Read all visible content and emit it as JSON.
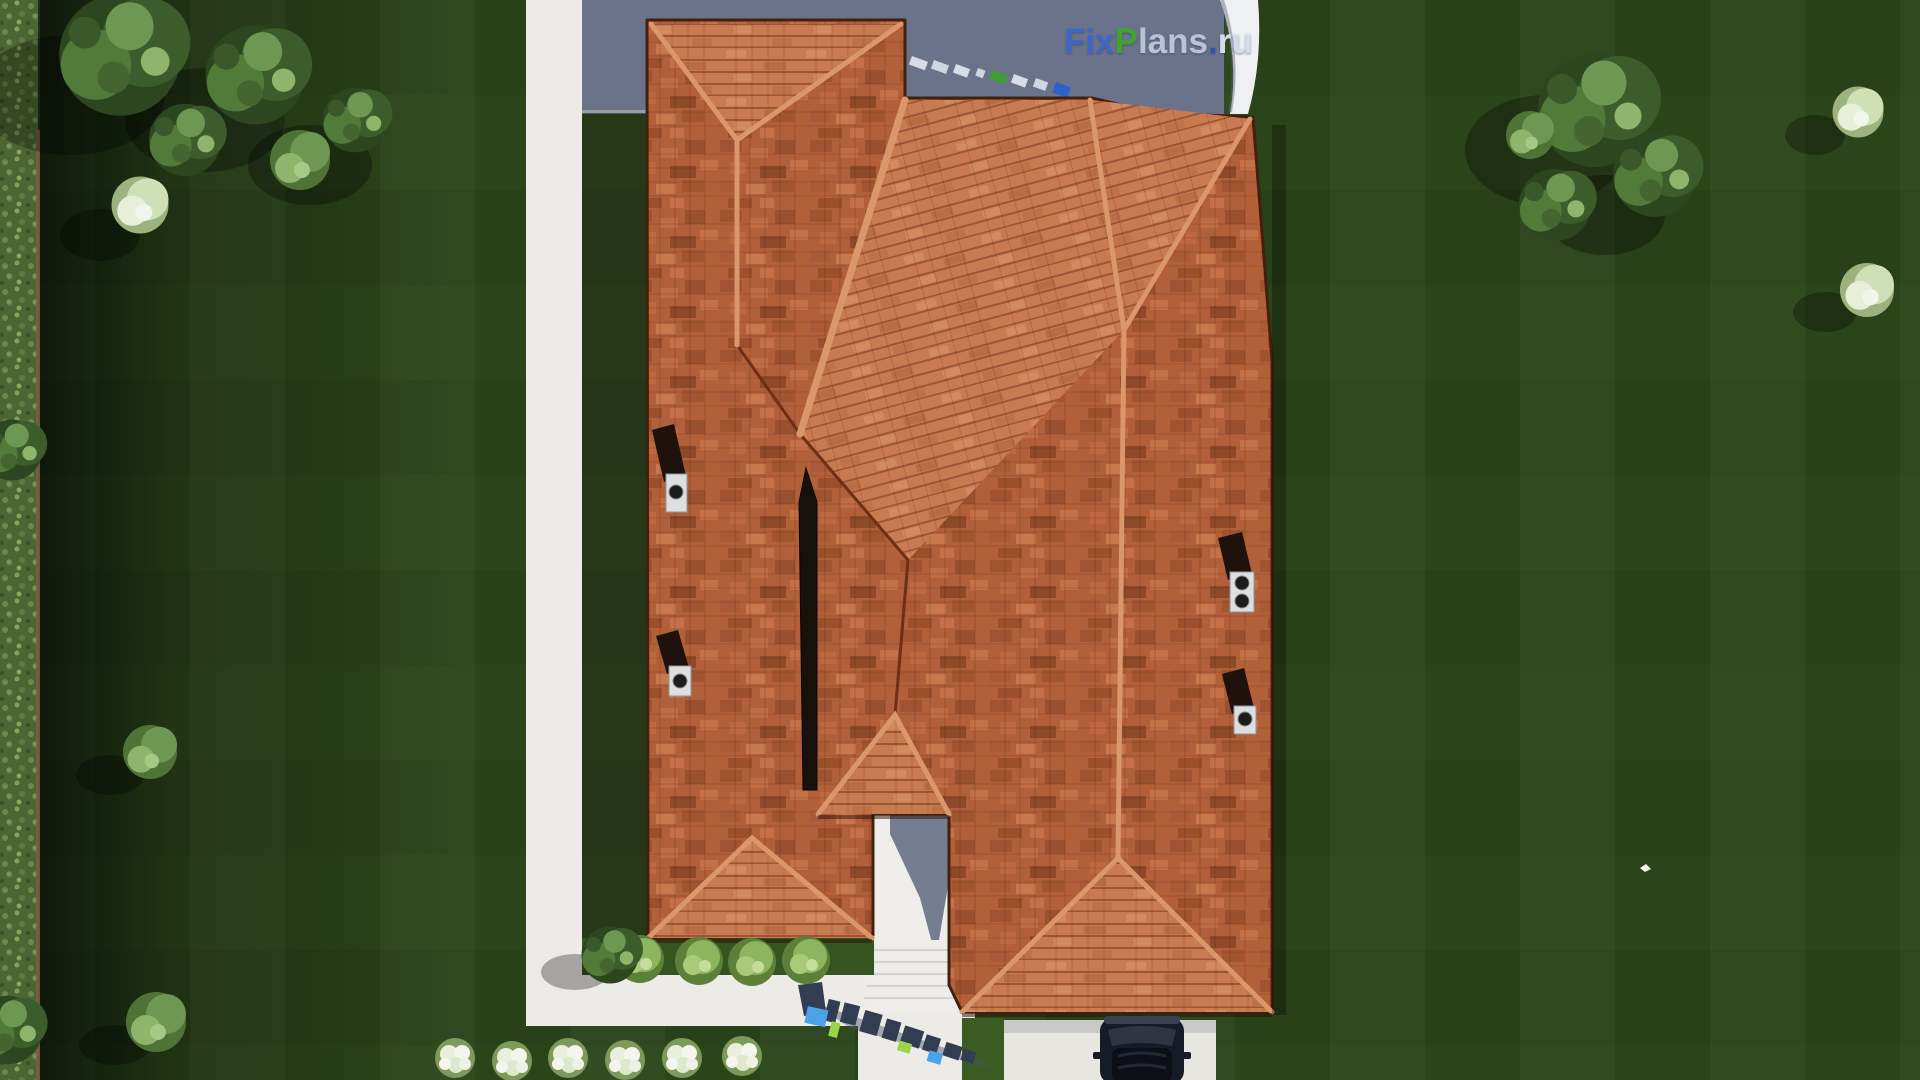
{
  "meta": {
    "view": "top-down aerial 3d architecture render",
    "subject": "single-family house with terracotta hip roof on a fenced lawn plot"
  },
  "watermark": {
    "brand_text": "FixPlans.ru",
    "segments": {
      "fix": "Fix",
      "p": "P",
      "lans": "lans",
      "dot": ".",
      "ru": "ru"
    },
    "ground_text_3d": "FixPlans.ru"
  },
  "palette": {
    "lawn": "#2a451a",
    "lawnShadow": "#16260c",
    "hedge": "#5e7c41",
    "terrace": "#6a7389",
    "path": "#edebe7",
    "driveway": "#e8e6e1",
    "roofBase": "#b2603a",
    "roofLight": "#c87b51",
    "ridgeCap": "#d9976a",
    "valley": "#6e3014",
    "skylight": "#17100b",
    "chimneyCap": "#dcdee0",
    "wmBlue": "#3f66c6",
    "wmGreen": "#3fa32e",
    "wmGray": "#b9c3d8",
    "wmDot": "#2b55b5",
    "wmRu": "#d5dbe7",
    "carBody": "#161b28"
  },
  "scene_inventory": {
    "chimneys": 4,
    "roof_skylight_strips": 1,
    "round_bushes_front": 4,
    "white_flower_clusters": 6,
    "large_trees_top_left": 6,
    "large_trees_right": 4,
    "white_flowering_trees_right": 2,
    "cars": 1,
    "terrace_watermark_blocks": 11
  }
}
